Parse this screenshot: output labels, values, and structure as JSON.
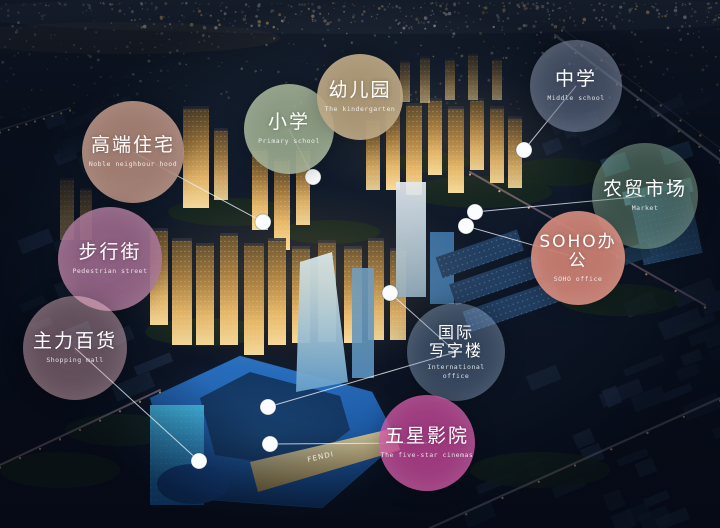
{
  "scene": {
    "mall_sign": "FENDI"
  },
  "bubbles": [
    {
      "id": "noble",
      "zh": "高端住宅",
      "en": "Noble neighbour hood",
      "x": 133,
      "y": 152,
      "r": 51,
      "bg": "rgba(171,132,118,0.92)"
    },
    {
      "id": "pedestrian",
      "zh": "步行街",
      "en": "Pedestrian street",
      "x": 110,
      "y": 259,
      "r": 52,
      "bg": "rgba(158,105,140,0.88)"
    },
    {
      "id": "shopping",
      "zh": "主力百货",
      "en": "Shopping mall",
      "x": 75,
      "y": 348,
      "r": 52,
      "bg": "rgba(224,170,180,0.42)"
    },
    {
      "id": "primary",
      "zh": "小学",
      "en": "Primary school",
      "x": 289,
      "y": 129,
      "r": 45,
      "bg": "rgba(153,168,140,0.90)"
    },
    {
      "id": "kindergarten",
      "zh": "幼儿园",
      "en": "The kindergarten",
      "x": 360,
      "y": 97,
      "r": 43,
      "bg": "rgba(181,160,122,0.92)"
    },
    {
      "id": "middle",
      "zh": "中学",
      "en": "Middle school",
      "x": 576,
      "y": 86,
      "r": 46,
      "bg": "rgba(100,114,140,0.58)"
    },
    {
      "id": "market",
      "zh": "农贸市场",
      "en": "Market",
      "x": 645,
      "y": 196,
      "r": 53,
      "bg": "rgba(112,152,122,0.48)"
    },
    {
      "id": "soho",
      "zh": "SOHO办公",
      "en": "SOHO office",
      "x": 578,
      "y": 258,
      "r": 47,
      "bg": "rgba(203,126,113,0.94)"
    },
    {
      "id": "intl",
      "zh": "国际\n写字楼",
      "en": "International\noffice",
      "x": 456,
      "y": 352,
      "r": 49,
      "bg": "rgba(118,150,186,0.38)"
    },
    {
      "id": "cinema",
      "zh": "五星影院",
      "en": "The five-star cinemas",
      "x": 427,
      "y": 443,
      "r": 48,
      "bg": "rgba(198,70,152,0.78)"
    }
  ],
  "connectors": [
    {
      "bubble": "noble",
      "dot": [
        263,
        222
      ]
    },
    {
      "bubble": "primary",
      "dot": [
        313,
        177
      ]
    },
    {
      "bubble": "middle",
      "dot": [
        524,
        150
      ]
    },
    {
      "bubble": "market",
      "dot": [
        475,
        212
      ]
    },
    {
      "bubble": "soho",
      "dot": [
        466,
        226
      ]
    },
    {
      "bubble": "intl",
      "dot": [
        390,
        293
      ]
    },
    {
      "bubble": "intl",
      "dot": [
        268,
        407
      ]
    },
    {
      "bubble": "cinema",
      "dot": [
        270,
        444
      ]
    },
    {
      "bubble": "shopping",
      "dot": [
        199,
        461
      ]
    }
  ]
}
